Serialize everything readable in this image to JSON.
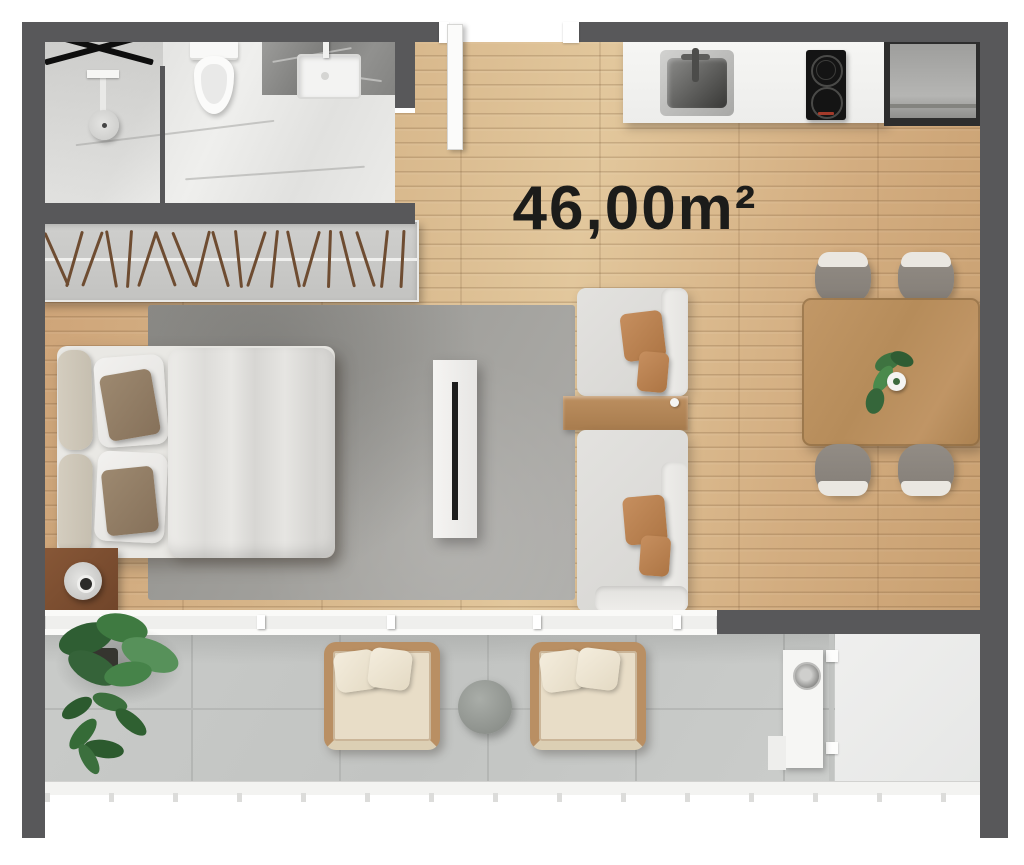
{
  "label": {
    "area": "46,00m²"
  },
  "colors": {
    "wall": "#58585a",
    "wood_floor": "#d2ab7d",
    "balcony_tile": "#c7c9c7",
    "rug": "#9c9b98",
    "marble": "#ebebe9",
    "counter": "#f4f4f2",
    "accent_pillow": "#bd8154",
    "table_wood": "#b98d5c",
    "plant_green": "#3e7340",
    "label_text": "#1c1c1a"
  },
  "rooms": {
    "bathroom": {
      "fixtures": [
        "towel-rack-x",
        "shower-head",
        "toilet",
        "vanity-sink"
      ]
    },
    "closet": {
      "hanger_count": 20,
      "hanger_angles": [
        -24,
        16,
        20,
        -10,
        4,
        18,
        -20,
        -22,
        14,
        -16,
        -6,
        18,
        6,
        -12,
        16,
        2,
        -14,
        -18,
        6,
        3
      ]
    },
    "kitchen": {
      "fixtures": [
        "kitchen-sink",
        "cooktop",
        "refrigerator"
      ],
      "cooktop_burners": 2
    },
    "living": {
      "furniture": [
        "double-bed",
        "nightstand-with-lamp",
        "tv-console",
        "modular-sofa",
        "sofa-side-console",
        "dining-table",
        "dining-chairs",
        "table-plant"
      ],
      "dining_chair_count": 4,
      "sofa_modules": 2
    },
    "balcony": {
      "items": [
        "large-leaf-plant",
        "fern-plant",
        "wicker-armchair",
        "wicker-armchair",
        "round-side-table",
        "utility-cabinet"
      ],
      "wicker_chair_count": 2,
      "slide_handle_positions": [
        55,
        212,
        342,
        488,
        628
      ]
    }
  }
}
